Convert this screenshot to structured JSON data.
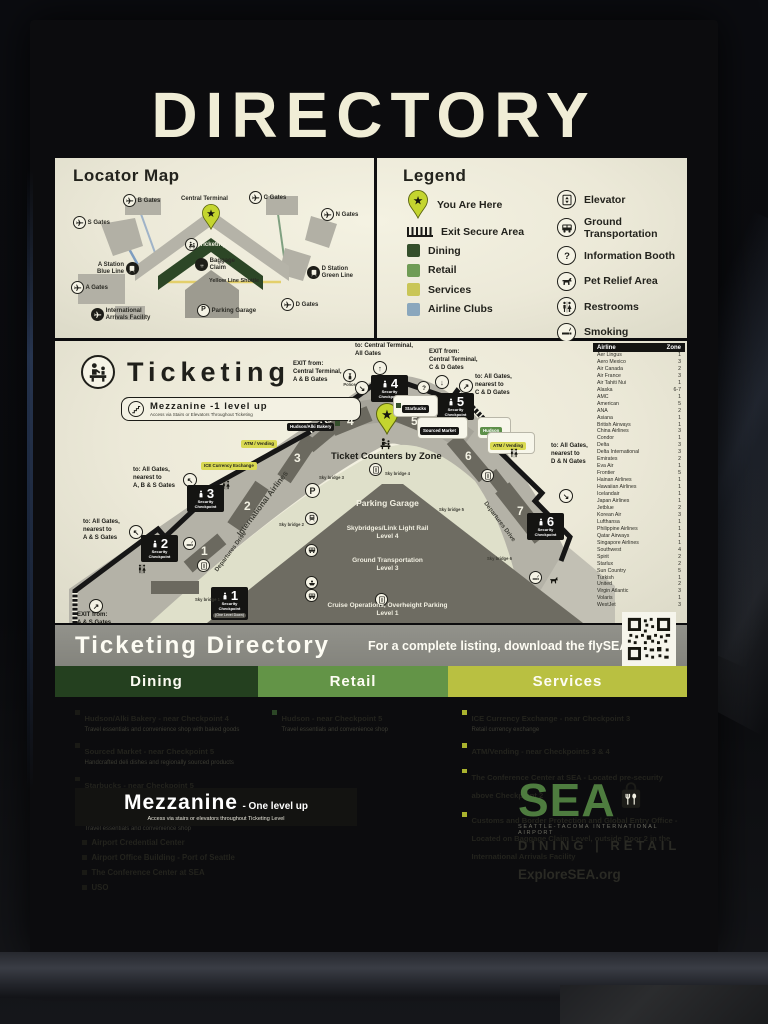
{
  "title": "DIRECTORY",
  "locator": {
    "title": "Locator Map",
    "labels": {
      "s_gates": "S Gates",
      "b_gates": "B Gates",
      "central_terminal": "Central Terminal",
      "c_gates": "C Gates",
      "n_gates": "N Gates",
      "a_station": "A Station\nBlue Line",
      "a_gates": "A Gates",
      "iaf": "International\nArrivals Facility",
      "ticketing": "Ticketing",
      "baggage": "Baggage\nClaim",
      "yellow_line": "Yellow Line  Shuttle",
      "parking": "Parking Garage",
      "d_station": "D Station\nGreen Line",
      "d_gates": "D Gates"
    }
  },
  "legend": {
    "title": "Legend",
    "you_are_here": "You Are Here",
    "exit_secure": "Exit Secure Area",
    "dining": "Dining",
    "retail": "Retail",
    "services": "Services",
    "airline_clubs": "Airline Clubs",
    "elevator": "Elevator",
    "ground": "Ground Transportation",
    "info": "Information Booth",
    "pet": "Pet Relief Area",
    "restrooms": "Restrooms",
    "smoking": "Smoking",
    "stairs": "Stairs",
    "colors": {
      "dining": "#344f2b",
      "retail": "#6f9c55",
      "services": "#c9c657",
      "airline_clubs": "#8aa7bd"
    }
  },
  "map": {
    "title": "Ticketing",
    "mezz_pill": {
      "title": "Mezzanine -1 level up",
      "sub": "Access via Stairs or Elevators Throughout Ticketing"
    },
    "police": "Police",
    "zones": [
      "1",
      "2",
      "3",
      "4",
      "5",
      "6",
      "7"
    ],
    "checkpoints": [
      {
        "num": "1",
        "label": "Security\nCheckpoint",
        "note": "(One Level Down)"
      },
      {
        "num": "2",
        "label": "Security\nCheckpoint"
      },
      {
        "num": "3",
        "label": "Security\nCheckpoint"
      },
      {
        "num": "4",
        "label": "Security\nCheckpoint"
      },
      {
        "num": "5",
        "label": "Security\nCheckpoint"
      },
      {
        "num": "6",
        "label": "Security\nCheckpoint"
      }
    ],
    "directions": {
      "exit_as": {
        "text": "EXIT from:\nA & S Gates",
        "arrow": "↗"
      },
      "to_as": {
        "text": "to: All Gates,\nnearest to\nA & S Gates",
        "arrow": "↖"
      },
      "to_abs": {
        "text": "to: All Gates,\nnearest to\nA, B & S Gates",
        "arrow": "↖"
      },
      "exit_ab": {
        "text": "EXIT from:\nCentral Terminal,\nA & B Gates",
        "arrow": "↘"
      },
      "to_ct": {
        "text": "to: Central Terminal,\nAll Gates",
        "arrow": "↑"
      },
      "exit_cd": {
        "text": "EXIT from:\nCentral Terminal,\nC & D Gates",
        "arrow": "↓"
      },
      "to_cd": {
        "text": "to: All Gates,\nnearest to\nC & D Gates",
        "arrow": "↗"
      },
      "to_dn": {
        "text": "to: All Gates,\nnearest to\nD & N Gates",
        "arrow": "↘"
      }
    },
    "tags": {
      "ice": "ICE Currency Exchange",
      "atm_left": "ATM / Vending",
      "alki": "Hudson/Alki Bakery",
      "starbucks": "Starbucks",
      "sourced": "Sourced Market",
      "hudson": "Hudson",
      "atm_right": "ATM / Vending"
    },
    "center": {
      "counters": "Ticket Counters by Zone",
      "parking": "Parking Garage",
      "skybridges": "Skybridges/Link Light Rail",
      "skybridges_lvl": "Level 4",
      "ground": "Ground Transportation",
      "ground_lvl": "Level 3",
      "cruise": "Cruise Operations, Overheight Parking",
      "cruise_lvl": "Level 1"
    },
    "roads": {
      "intl": "International Airlines",
      "dep_left": "Departures Drive",
      "dep_right": "Departures Drive"
    },
    "skybridges": [
      "Sky bridge 1",
      "Sky bridge 2",
      "Sky bridge 3",
      "Sky bridge 4",
      "Sky bridge 5",
      "Sky bridge 6"
    ]
  },
  "airlines": {
    "headers": [
      "Airline",
      "Zone"
    ],
    "rows": [
      [
        "Aer Lingus",
        "1"
      ],
      [
        "Aero Mexico",
        "3"
      ],
      [
        "Air Canada",
        "2"
      ],
      [
        "Air France",
        "3"
      ],
      [
        "Air Tahiti Nui",
        "1"
      ],
      [
        "Alaska",
        "6-7"
      ],
      [
        "AMC",
        "1"
      ],
      [
        "American",
        "5"
      ],
      [
        "ANA",
        "2"
      ],
      [
        "Asiana",
        "1"
      ],
      [
        "British Airways",
        "1"
      ],
      [
        "China Airlines",
        "3"
      ],
      [
        "Condor",
        "1"
      ],
      [
        "Delta",
        "3"
      ],
      [
        "Delta International",
        "3"
      ],
      [
        "Emirates",
        "2"
      ],
      [
        "Eva Air",
        "1"
      ],
      [
        "Frontier",
        "5"
      ],
      [
        "Hainan Airlines",
        "1"
      ],
      [
        "Hawaiian Airlines",
        "1"
      ],
      [
        "Icelandair",
        "1"
      ],
      [
        "Japan Airlines",
        "1"
      ],
      [
        "Jetblue",
        "2"
      ],
      [
        "Korean Air",
        "3"
      ],
      [
        "Lufthansa",
        "1"
      ],
      [
        "Philippine Airlines",
        "1"
      ],
      [
        "Qatar Airways",
        "1"
      ],
      [
        "Singapore Airlines",
        "1"
      ],
      [
        "Southwest",
        "4"
      ],
      [
        "Spirit",
        "2"
      ],
      [
        "Starlux",
        "2"
      ],
      [
        "Sun Country",
        "5"
      ],
      [
        "Turkish",
        "1"
      ],
      [
        "United",
        "2"
      ],
      [
        "Virgin Atlantic",
        "3"
      ],
      [
        "Volaris",
        "1"
      ],
      [
        "WestJet",
        "3"
      ]
    ]
  },
  "directory": {
    "title": "Ticketing Directory",
    "note": "For a complete listing, download the flySEA App",
    "dining": {
      "label": "Dining",
      "items": [
        {
          "name": "Hudson/Alki Bakery - near Checkpoint 4",
          "desc": "Travel essentials and convenience shop with baked goods"
        },
        {
          "name": "Sourced Market - near Checkpoint 5",
          "desc": "Handcrafted deli dishes and regionally sourced products"
        },
        {
          "name": "Starbucks - near Checkpoint 5",
          "desc": "Coffee, premium teas, pastries and other treats"
        },
        {
          "name": "Hudson",
          "desc": "Travel essentials and convenience shop"
        }
      ]
    },
    "retail": {
      "label": "Retail",
      "items": [
        {
          "name": "Hudson - near Checkpoint 5",
          "desc": "Travel essentials and convenience shop"
        }
      ]
    },
    "services": {
      "label": "Services",
      "items": [
        {
          "name": "ICE Currency Exchange - near Checkpoint 3",
          "desc": "Retail currency exchange"
        },
        {
          "name": "ATM/Vending - near Checkpoints 3 & 4",
          "desc": ""
        },
        {
          "name": "The Conference Center at SEA - Located pre-security above Checkpoint 2",
          "desc": ""
        },
        {
          "name": "Customs and Border Protection and Global Entry Office - Located on Baggage Claim Level, outside Door 2 in the International Arrivals Facility",
          "desc": ""
        }
      ]
    }
  },
  "mezzanine": {
    "title": "Mezzanine",
    "suffix": "- One level up",
    "sub": "Access via stairs or elevators throughout Ticketing Level",
    "items": [
      "Airport Credential Center",
      "Airport Office Building - Port of Seattle",
      "The Conference Center at SEA",
      "USO"
    ]
  },
  "branding": {
    "sea": "SEA",
    "airport": "SEATTLE-TACOMA INTERNATIONAL AIRPORT",
    "tagline": "DINING | RETAIL",
    "url": "ExploreSEA.org"
  }
}
